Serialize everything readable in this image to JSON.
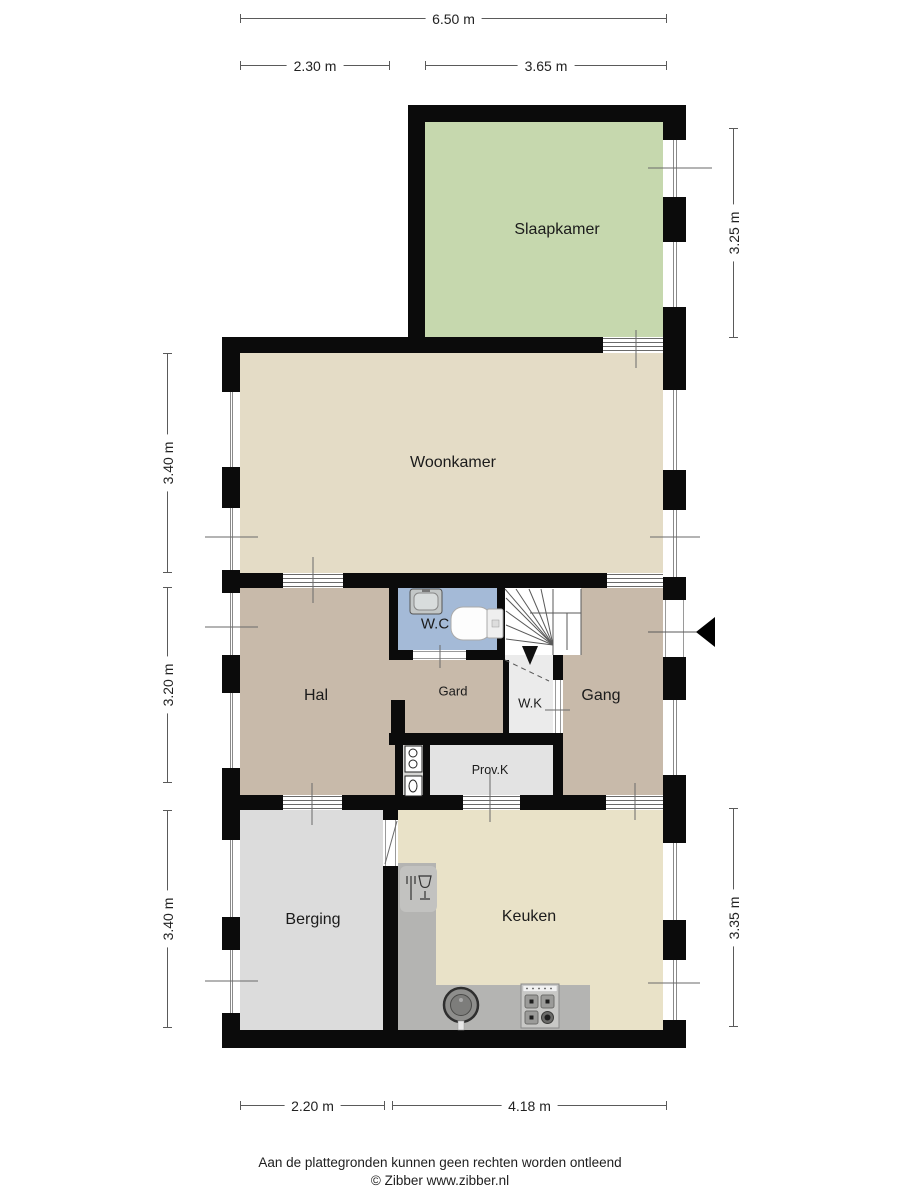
{
  "rooms": {
    "slaapkamer": "Slaapkamer",
    "woonkamer": "Woonkamer",
    "hal": "Hal",
    "wc": "W.C",
    "gard": "Gard",
    "wk": "W.K",
    "gang": "Gang",
    "provk": "Prov.K",
    "berging": "Berging",
    "keuken": "Keuken"
  },
  "dimensions": {
    "top_total": "6.50 m",
    "top_left": "2.30 m",
    "top_right": "3.65 m",
    "left_upper": "3.40 m",
    "left_middle": "3.20 m",
    "left_lower": "3.40 m",
    "right_upper": "3.25 m",
    "right_lower": "3.35 m",
    "bottom_left": "2.20 m",
    "bottom_right": "4.18 m"
  },
  "icons": {
    "entrance": "entrance-arrow-icon",
    "stairs": "staircase-with-down-arrow",
    "wc_fixtures": [
      "washbasin-icon",
      "toilet-icon"
    ],
    "meter_cupboard": "utility-meters-icon",
    "kitchen_fixtures": [
      "dishwasher-icon",
      "kitchen-sink-icon",
      "stove-icon"
    ]
  },
  "colors": {
    "wall": "#0b0b0b",
    "slaapkamer": "#c6d8ae",
    "woonkamer": "#e4dcc6",
    "hal_gang_gard": "#c8baaa",
    "wc": "#a4bad7",
    "wk": "#ebebeb",
    "provk": "#e3e3e3",
    "berging": "#dcdcdc",
    "keuken": "#e9e2c8",
    "counter": "#b4b4b2",
    "stairs": "#ffffff",
    "dimension_line": "#5a5a5a"
  },
  "footer": {
    "disclaimer": "Aan de plattegronden kunnen geen rechten worden ontleend",
    "copyright": "© Zibber www.zibber.nl"
  }
}
